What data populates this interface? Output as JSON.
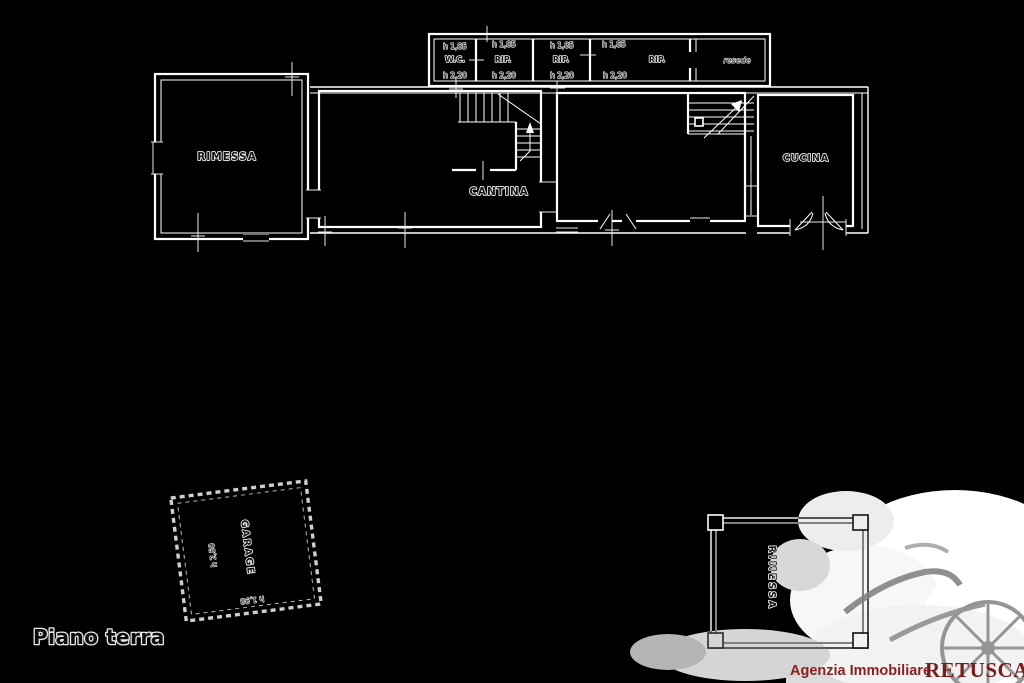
{
  "floor_plan": {
    "title": "Piano terra",
    "strip_rooms": [
      {
        "h_top": "h 1,85",
        "label": "W.C.",
        "h_bottom": "h 2,20"
      },
      {
        "h_top": "h 1,85",
        "label": "RIP.",
        "h_bottom": "h 2,20"
      },
      {
        "h_top": "h 1,85",
        "label": "RIP.",
        "h_bottom": "h 2,20"
      },
      {
        "h_top": "h 1,85",
        "label": "RIP.",
        "h_bottom": "h 2,20"
      },
      {
        "label": "resede"
      }
    ],
    "rooms": {
      "rimessa": "RIMESSA",
      "cantina": "CANTINA",
      "cucina": "CUCINA"
    },
    "garage": {
      "label": "GARAGE",
      "height_main": "h 2,50",
      "height_edge": "h 1,98"
    },
    "outbuilding": {
      "label": "RIMESSA"
    }
  },
  "footer": {
    "agency": "Agenzia Immobiliare",
    "brand": "RETUSCANY"
  },
  "colors": {
    "background": "#000000",
    "plan_line": "#ffffff",
    "label_fill": "#161616",
    "label_halo": "#f0f0f0",
    "brand_red": "#8b2020",
    "watermark": "#e8e8e8"
  }
}
